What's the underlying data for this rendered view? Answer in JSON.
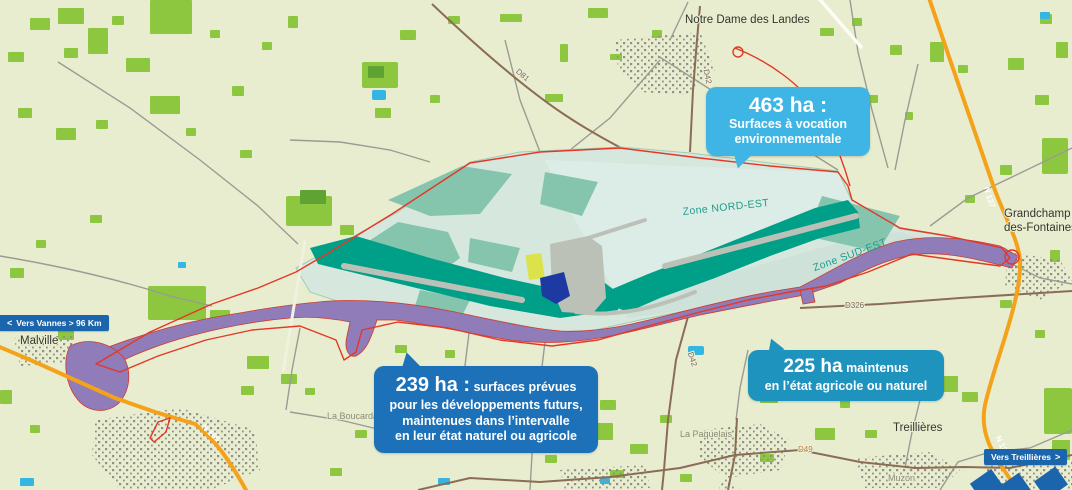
{
  "towns": {
    "notre_dame": "Notre Dame des Landes",
    "malville": "Malville",
    "grandchamp_l1": "Grandchamp",
    "grandchamp_l2": "des-Fontaines",
    "treillieres": "Treillières"
  },
  "hamlets": {
    "la_boucardais": "La Boucardais",
    "la_paquelais": "La Paquelais",
    "muzon": "Muzon"
  },
  "road_labels": {
    "d81": "D81",
    "d42_north": "D42",
    "d42_south": "D42",
    "d326": "D326",
    "d49": "D49",
    "n137_north": "N 137",
    "n137_south": "N 137",
    "n165": "N 165"
  },
  "zones": {
    "nord_est": "Zone NORD-EST",
    "sud_est": "Zone SUD-EST"
  },
  "callouts": {
    "environment": {
      "value": "463 ha :",
      "line1": "Surfaces à vocation",
      "line2": "environnementale",
      "color": "#3fb5e5"
    },
    "future": {
      "value": "239 ha :",
      "suffix": "surfaces prévues",
      "line2": "pour les développements futurs,",
      "line3": "maintenues dans l’intervalle",
      "line4": "en leur état naturel ou agricole",
      "color": "#1d71b8"
    },
    "maintained": {
      "value": "225 ha",
      "suffix": "maintenus",
      "line2": "en l’état agricole ou naturel",
      "color": "#1e93be"
    }
  },
  "signs": {
    "vers_vannes": "Vers Vannes > 96 Km",
    "vers_treillieres": "Vers Treillières",
    "chevron_left": "<",
    "chevron_right": ">"
  },
  "colors": {
    "background": "#e9edcf",
    "forest_green": "#8dc63f",
    "zone_pale": "#d6e8dd",
    "zone_nord_est": "#dcede7",
    "zone_sud_est": "#cfe2d9",
    "zone_teal_medium": "#85c5ad",
    "zone_teal_dark": "#00a088",
    "corridor_purple": "#8f7cb8",
    "boundary_red": "#e53726",
    "highway_orange": "#f5a21b",
    "sign_blue": "#1b65ad",
    "water_blue": "#35b6e2"
  }
}
